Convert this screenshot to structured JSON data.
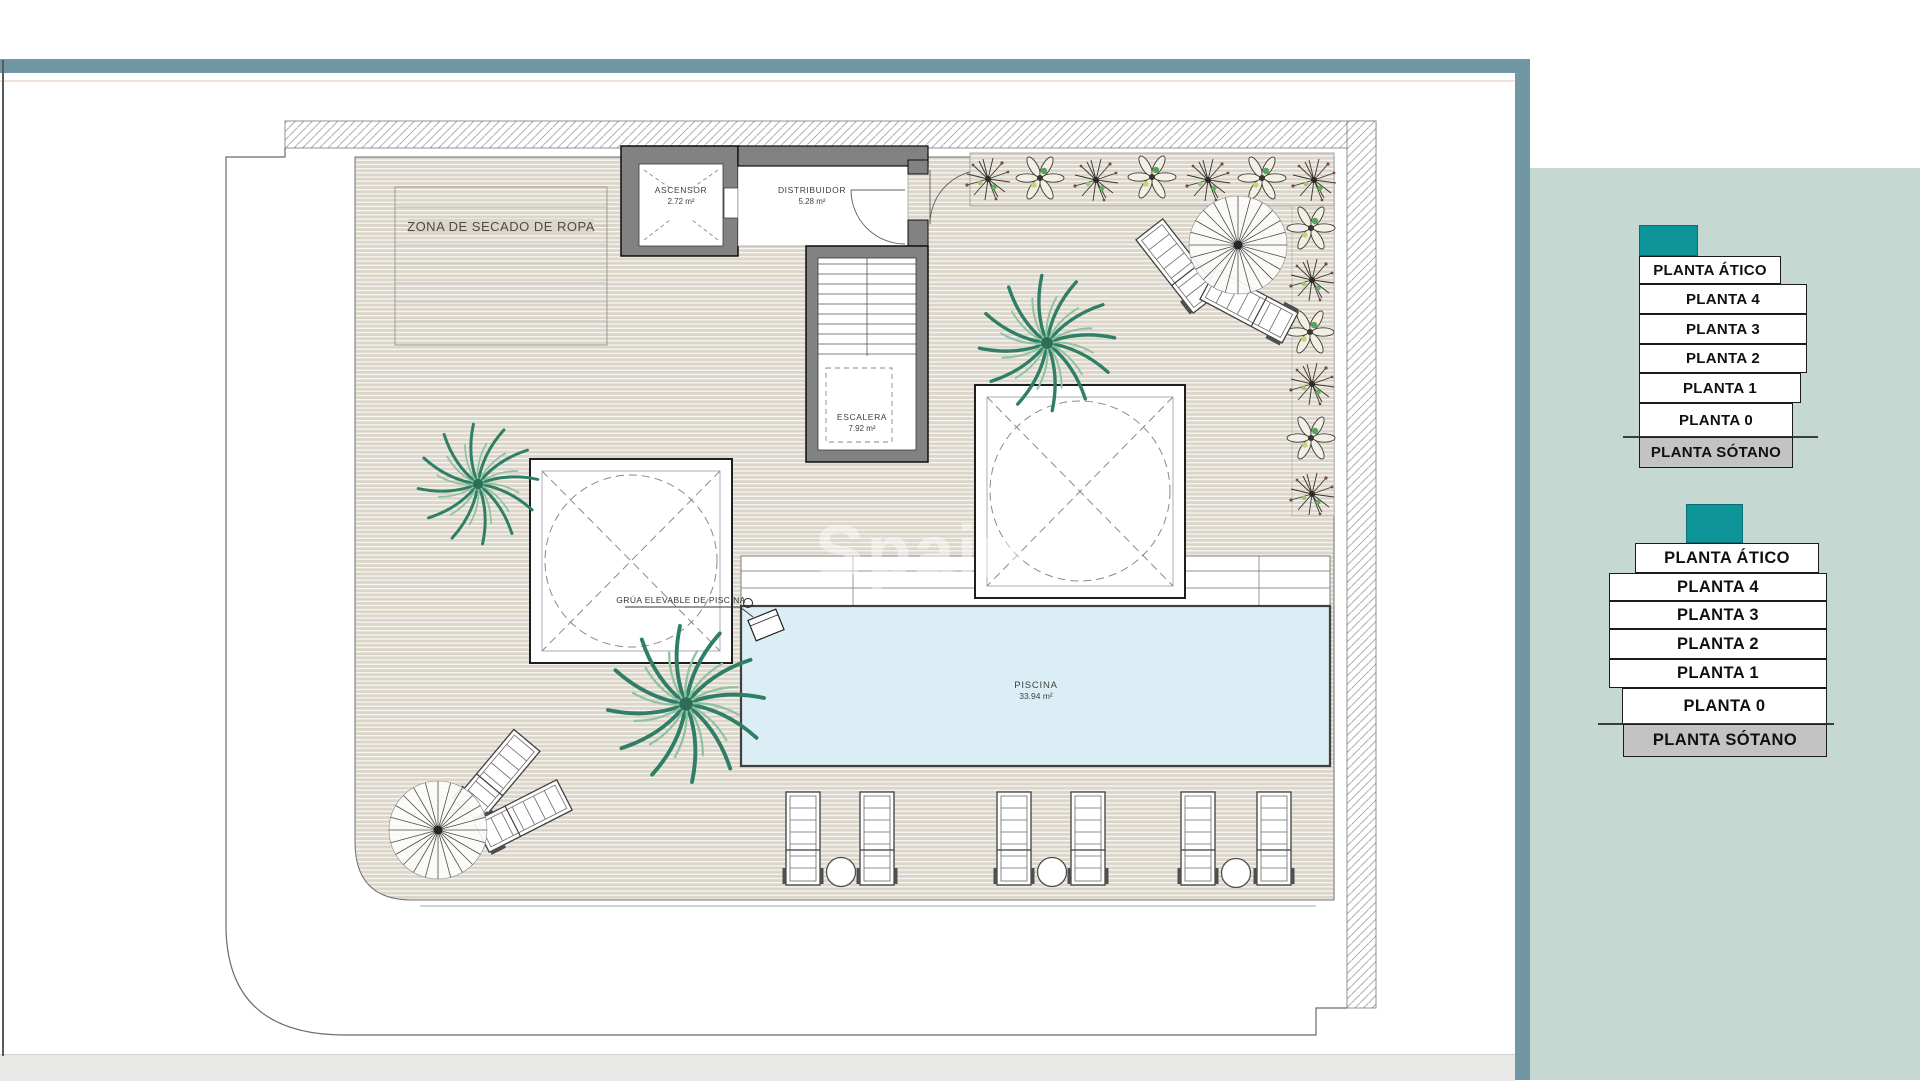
{
  "frame": {
    "bar_color": "#7097a3",
    "panel_color": "#c5d9d2",
    "accent_color": "#0d9599",
    "basement_color": "#c3c3c3"
  },
  "watermark": {
    "text": "Spain"
  },
  "plan": {
    "zona_label": "ZONA DE SECADO DE ROPA",
    "ascensor_label": "ASCENSOR",
    "ascensor_area": "2.72 m²",
    "distribuidor_label": "DISTRIBUIDOR",
    "distribuidor_area": "5.28 m²",
    "escalera_label": "ESCALERA",
    "escalera_area": "7.92 m²",
    "piscina_label": "PISCINA",
    "piscina_area": "33.94 m²",
    "grua_label": "GRÚA ELEVABLE DE PISCINA"
  },
  "floor_selector_top": {
    "floors": [
      {
        "label": "PLANTA ÁTICO"
      },
      {
        "label": "PLANTA 4"
      },
      {
        "label": "PLANTA 3"
      },
      {
        "label": "PLANTA 2"
      },
      {
        "label": "PLANTA 1"
      },
      {
        "label": "PLANTA 0"
      },
      {
        "label": "PLANTA SÓTANO"
      }
    ]
  },
  "floor_selector_bottom": {
    "floors": [
      {
        "label": "PLANTA ÁTICO"
      },
      {
        "label": "PLANTA 4"
      },
      {
        "label": "PLANTA 3"
      },
      {
        "label": "PLANTA 2"
      },
      {
        "label": "PLANTA 1"
      },
      {
        "label": "PLANTA 0"
      },
      {
        "label": "PLANTA SÓTANO"
      }
    ]
  }
}
